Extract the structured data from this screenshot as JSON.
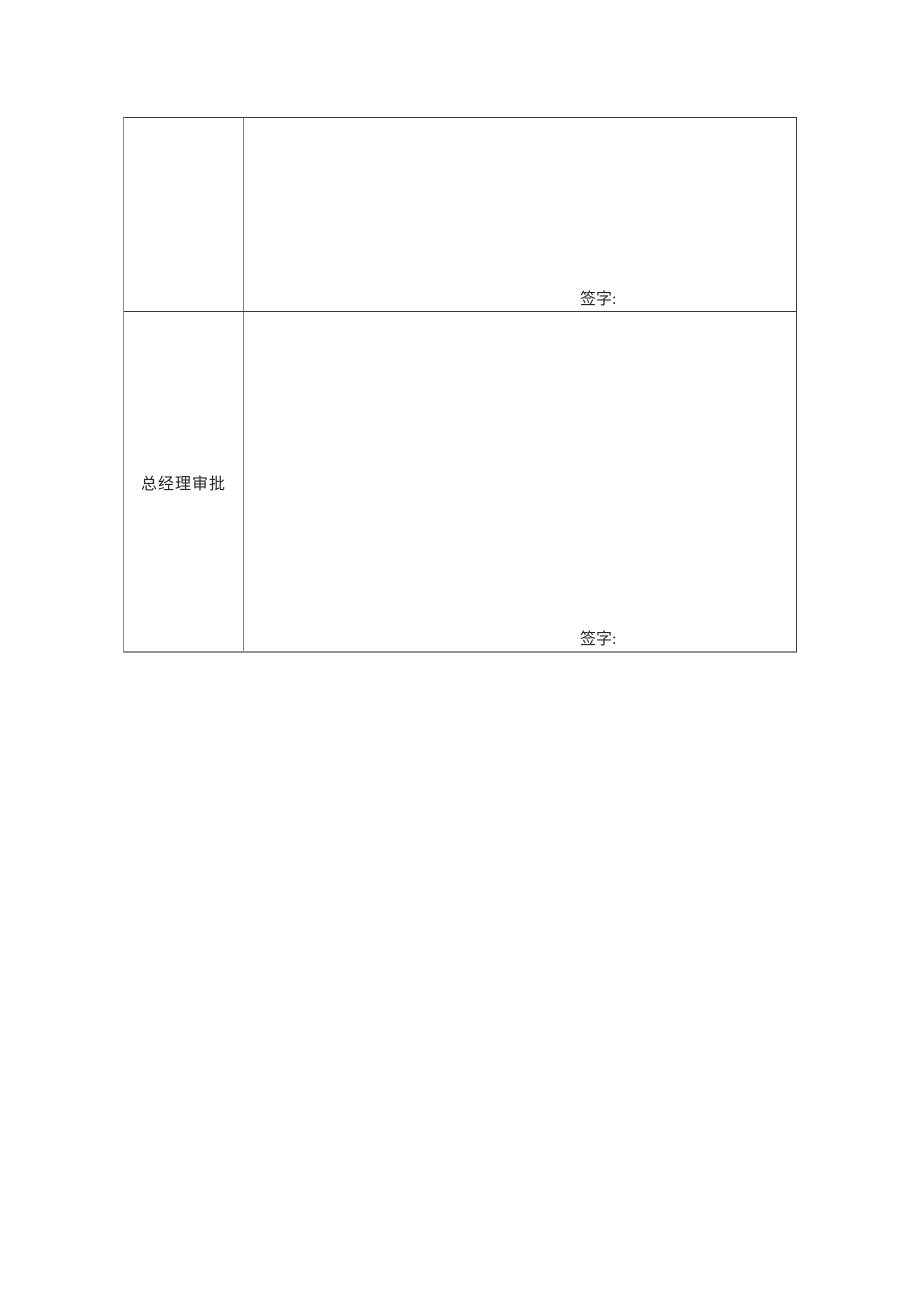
{
  "document": {
    "background": "#ffffff",
    "text_color": "#262626",
    "table": {
      "border_color_horizontal": "#3a3a3a",
      "border_color_vertical": "#8e8e8e",
      "rows": [
        {
          "approver_label": "",
          "signature_label": "签字:"
        },
        {
          "approver_label": "总经理审批",
          "signature_label": "签字:"
        }
      ]
    }
  }
}
